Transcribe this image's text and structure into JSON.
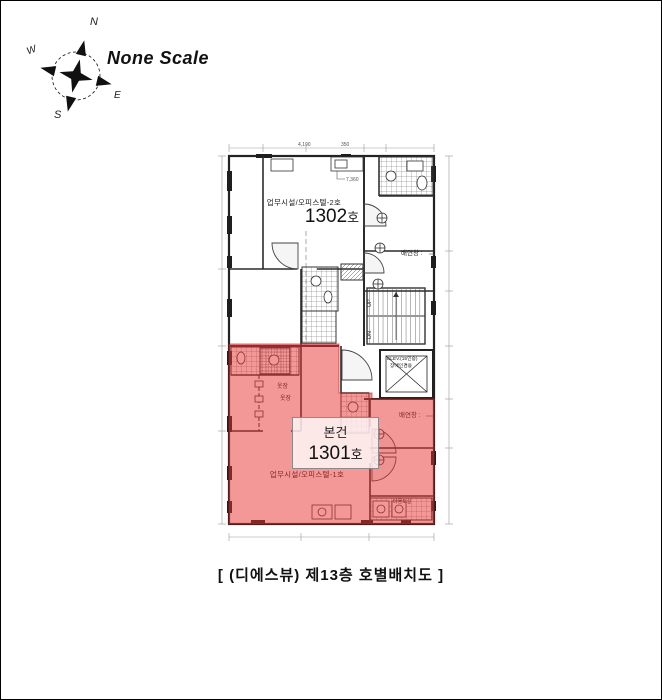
{
  "page": {
    "background": "#ffffff",
    "border_color": "#000000"
  },
  "compass": {
    "north": "N",
    "east": "E",
    "south": "S",
    "west": "W",
    "north_color": "#b83226",
    "south_color": "#2a6fb0",
    "scale_label": "None Scale"
  },
  "plan": {
    "line_color": "#2b2b2b",
    "highlight_color": "#e83030",
    "unit_1302": {
      "usage": "업무시설/오피스텔-2호",
      "number": "1302",
      "suffix": "호"
    },
    "unit_1301": {
      "usage": "업무시설/오피스텔-1호",
      "number": "1301",
      "suffix": "호",
      "subject": "본건"
    },
    "stairs": {
      "up": "UP",
      "down": "DN"
    },
    "elevator": {
      "name": "ELEV.(15인승)",
      "sub": "장애인겸용"
    },
    "labels": {
      "vent_top": "배연창 :",
      "vent_bottom": "배연창 :",
      "closet_a": "옷장",
      "closet_b": "옷장",
      "utility": "다용도실"
    },
    "dimensions": {
      "top_a": "4,190",
      "top_b": "350",
      "inner": "7,360"
    }
  },
  "caption": "[ (디에스뷰) 제13층 호별배치도 ]"
}
